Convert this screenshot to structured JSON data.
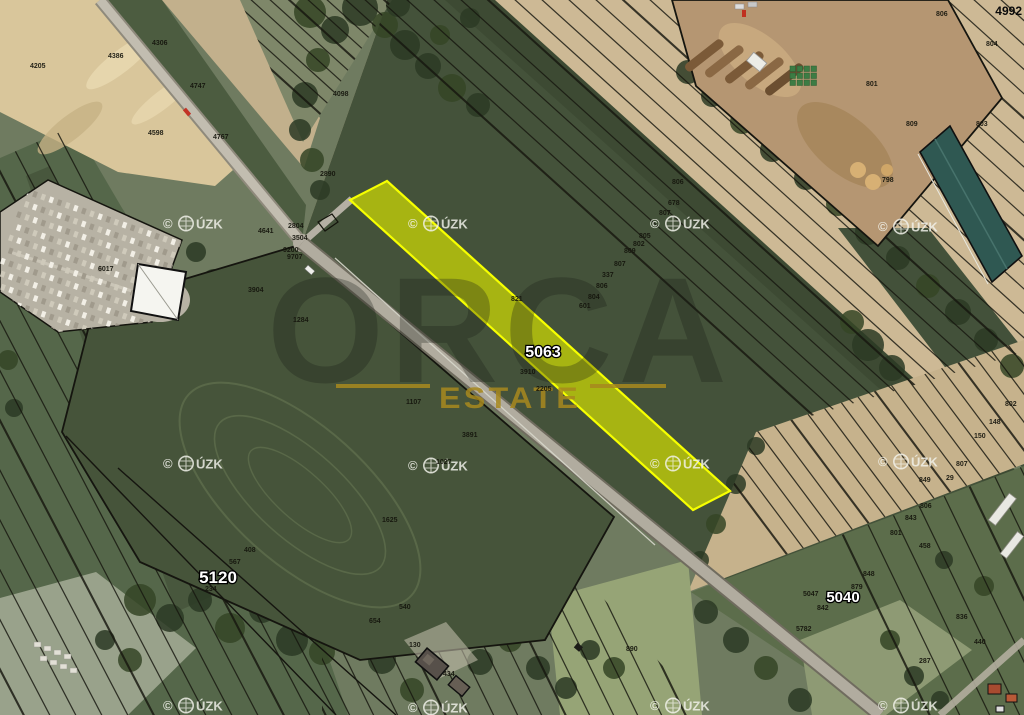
{
  "map": {
    "title": "Cadastral aerial map with highlighted parcel",
    "region_labels": {
      "highlighted_parcel": "5063",
      "field_left": "5120",
      "field_right": "5040",
      "corner": "4992"
    },
    "brand_watermark": {
      "word": "ORCA",
      "sub": "ESTATE",
      "gold": "#a8891e"
    },
    "copyright_watermark": {
      "text": "© ČÚZK",
      "prefix": "©",
      "suffix": "ÚZK",
      "positions": [
        [
          163,
          215
        ],
        [
          408,
          215
        ],
        [
          650,
          215
        ],
        [
          878,
          218
        ],
        [
          163,
          455
        ],
        [
          408,
          457
        ],
        [
          650,
          455
        ],
        [
          878,
          453
        ],
        [
          163,
          697
        ],
        [
          408,
          699
        ],
        [
          650,
          697
        ],
        [
          878,
          697
        ]
      ]
    },
    "colors": {
      "highlight_fill": "#c3cf08",
      "highlight_border": "#f6ff00",
      "gold": "#a8891e",
      "cuzk_white": "#f3f3ec"
    },
    "small_parcel_numbers": [
      {
        "t": "4205",
        "x": 30,
        "y": 68
      },
      {
        "t": "4386",
        "x": 108,
        "y": 58
      },
      {
        "t": "4747",
        "x": 190,
        "y": 88
      },
      {
        "t": "4598",
        "x": 148,
        "y": 135
      },
      {
        "t": "4767",
        "x": 213,
        "y": 139
      },
      {
        "t": "4306",
        "x": 152,
        "y": 45
      },
      {
        "t": "4098",
        "x": 333,
        "y": 96
      },
      {
        "t": "2890",
        "x": 320,
        "y": 176
      },
      {
        "t": "4641",
        "x": 258,
        "y": 233
      },
      {
        "t": "2804",
        "x": 288,
        "y": 228
      },
      {
        "t": "3504",
        "x": 292,
        "y": 240
      },
      {
        "t": "9200",
        "x": 283,
        "y": 252
      },
      {
        "t": "9707",
        "x": 287,
        "y": 259
      },
      {
        "t": "3904",
        "x": 248,
        "y": 292
      },
      {
        "t": "1284",
        "x": 293,
        "y": 322
      },
      {
        "t": "6017",
        "x": 98,
        "y": 271
      },
      {
        "t": "806",
        "x": 672,
        "y": 184
      },
      {
        "t": "678",
        "x": 668,
        "y": 205
      },
      {
        "t": "807",
        "x": 659,
        "y": 215
      },
      {
        "t": "805",
        "x": 639,
        "y": 238
      },
      {
        "t": "802",
        "x": 633,
        "y": 246
      },
      {
        "t": "809",
        "x": 624,
        "y": 253
      },
      {
        "t": "807",
        "x": 614,
        "y": 266
      },
      {
        "t": "337",
        "x": 602,
        "y": 277
      },
      {
        "t": "806",
        "x": 596,
        "y": 288
      },
      {
        "t": "804",
        "x": 588,
        "y": 299
      },
      {
        "t": "601",
        "x": 579,
        "y": 308
      },
      {
        "t": "821",
        "x": 511,
        "y": 301
      },
      {
        "t": "3910",
        "x": 520,
        "y": 374
      },
      {
        "t": "2205",
        "x": 536,
        "y": 391
      },
      {
        "t": "1107",
        "x": 406,
        "y": 404
      },
      {
        "t": "3891",
        "x": 462,
        "y": 437
      },
      {
        "t": "1027",
        "x": 436,
        "y": 464
      },
      {
        "t": "1625",
        "x": 382,
        "y": 522
      },
      {
        "t": "408",
        "x": 244,
        "y": 552
      },
      {
        "t": "567",
        "x": 229,
        "y": 564
      },
      {
        "t": "234",
        "x": 205,
        "y": 591
      },
      {
        "t": "848",
        "x": 863,
        "y": 576
      },
      {
        "t": "879",
        "x": 851,
        "y": 589
      },
      {
        "t": "5047",
        "x": 803,
        "y": 596
      },
      {
        "t": "842",
        "x": 817,
        "y": 610
      },
      {
        "t": "5782",
        "x": 796,
        "y": 631
      },
      {
        "t": "802",
        "x": 1005,
        "y": 406
      },
      {
        "t": "148",
        "x": 989,
        "y": 424
      },
      {
        "t": "150",
        "x": 974,
        "y": 438
      },
      {
        "t": "807",
        "x": 956,
        "y": 466
      },
      {
        "t": "29",
        "x": 946,
        "y": 480
      },
      {
        "t": "849",
        "x": 919,
        "y": 482
      },
      {
        "t": "806",
        "x": 920,
        "y": 508
      },
      {
        "t": "458",
        "x": 919,
        "y": 548
      },
      {
        "t": "843",
        "x": 905,
        "y": 520
      },
      {
        "t": "801",
        "x": 890,
        "y": 535
      },
      {
        "t": "806",
        "x": 936,
        "y": 16
      },
      {
        "t": "804",
        "x": 986,
        "y": 46
      },
      {
        "t": "801",
        "x": 866,
        "y": 86
      },
      {
        "t": "809",
        "x": 906,
        "y": 126
      },
      {
        "t": "803",
        "x": 976,
        "y": 126
      },
      {
        "t": "798",
        "x": 882,
        "y": 182
      },
      {
        "t": "540",
        "x": 399,
        "y": 609
      },
      {
        "t": "654",
        "x": 369,
        "y": 623
      },
      {
        "t": "130",
        "x": 409,
        "y": 647
      },
      {
        "t": "434",
        "x": 443,
        "y": 676
      },
      {
        "t": "890",
        "x": 626,
        "y": 651
      },
      {
        "t": "836",
        "x": 956,
        "y": 619
      },
      {
        "t": "440",
        "x": 974,
        "y": 644
      },
      {
        "t": "287",
        "x": 919,
        "y": 663
      }
    ]
  }
}
